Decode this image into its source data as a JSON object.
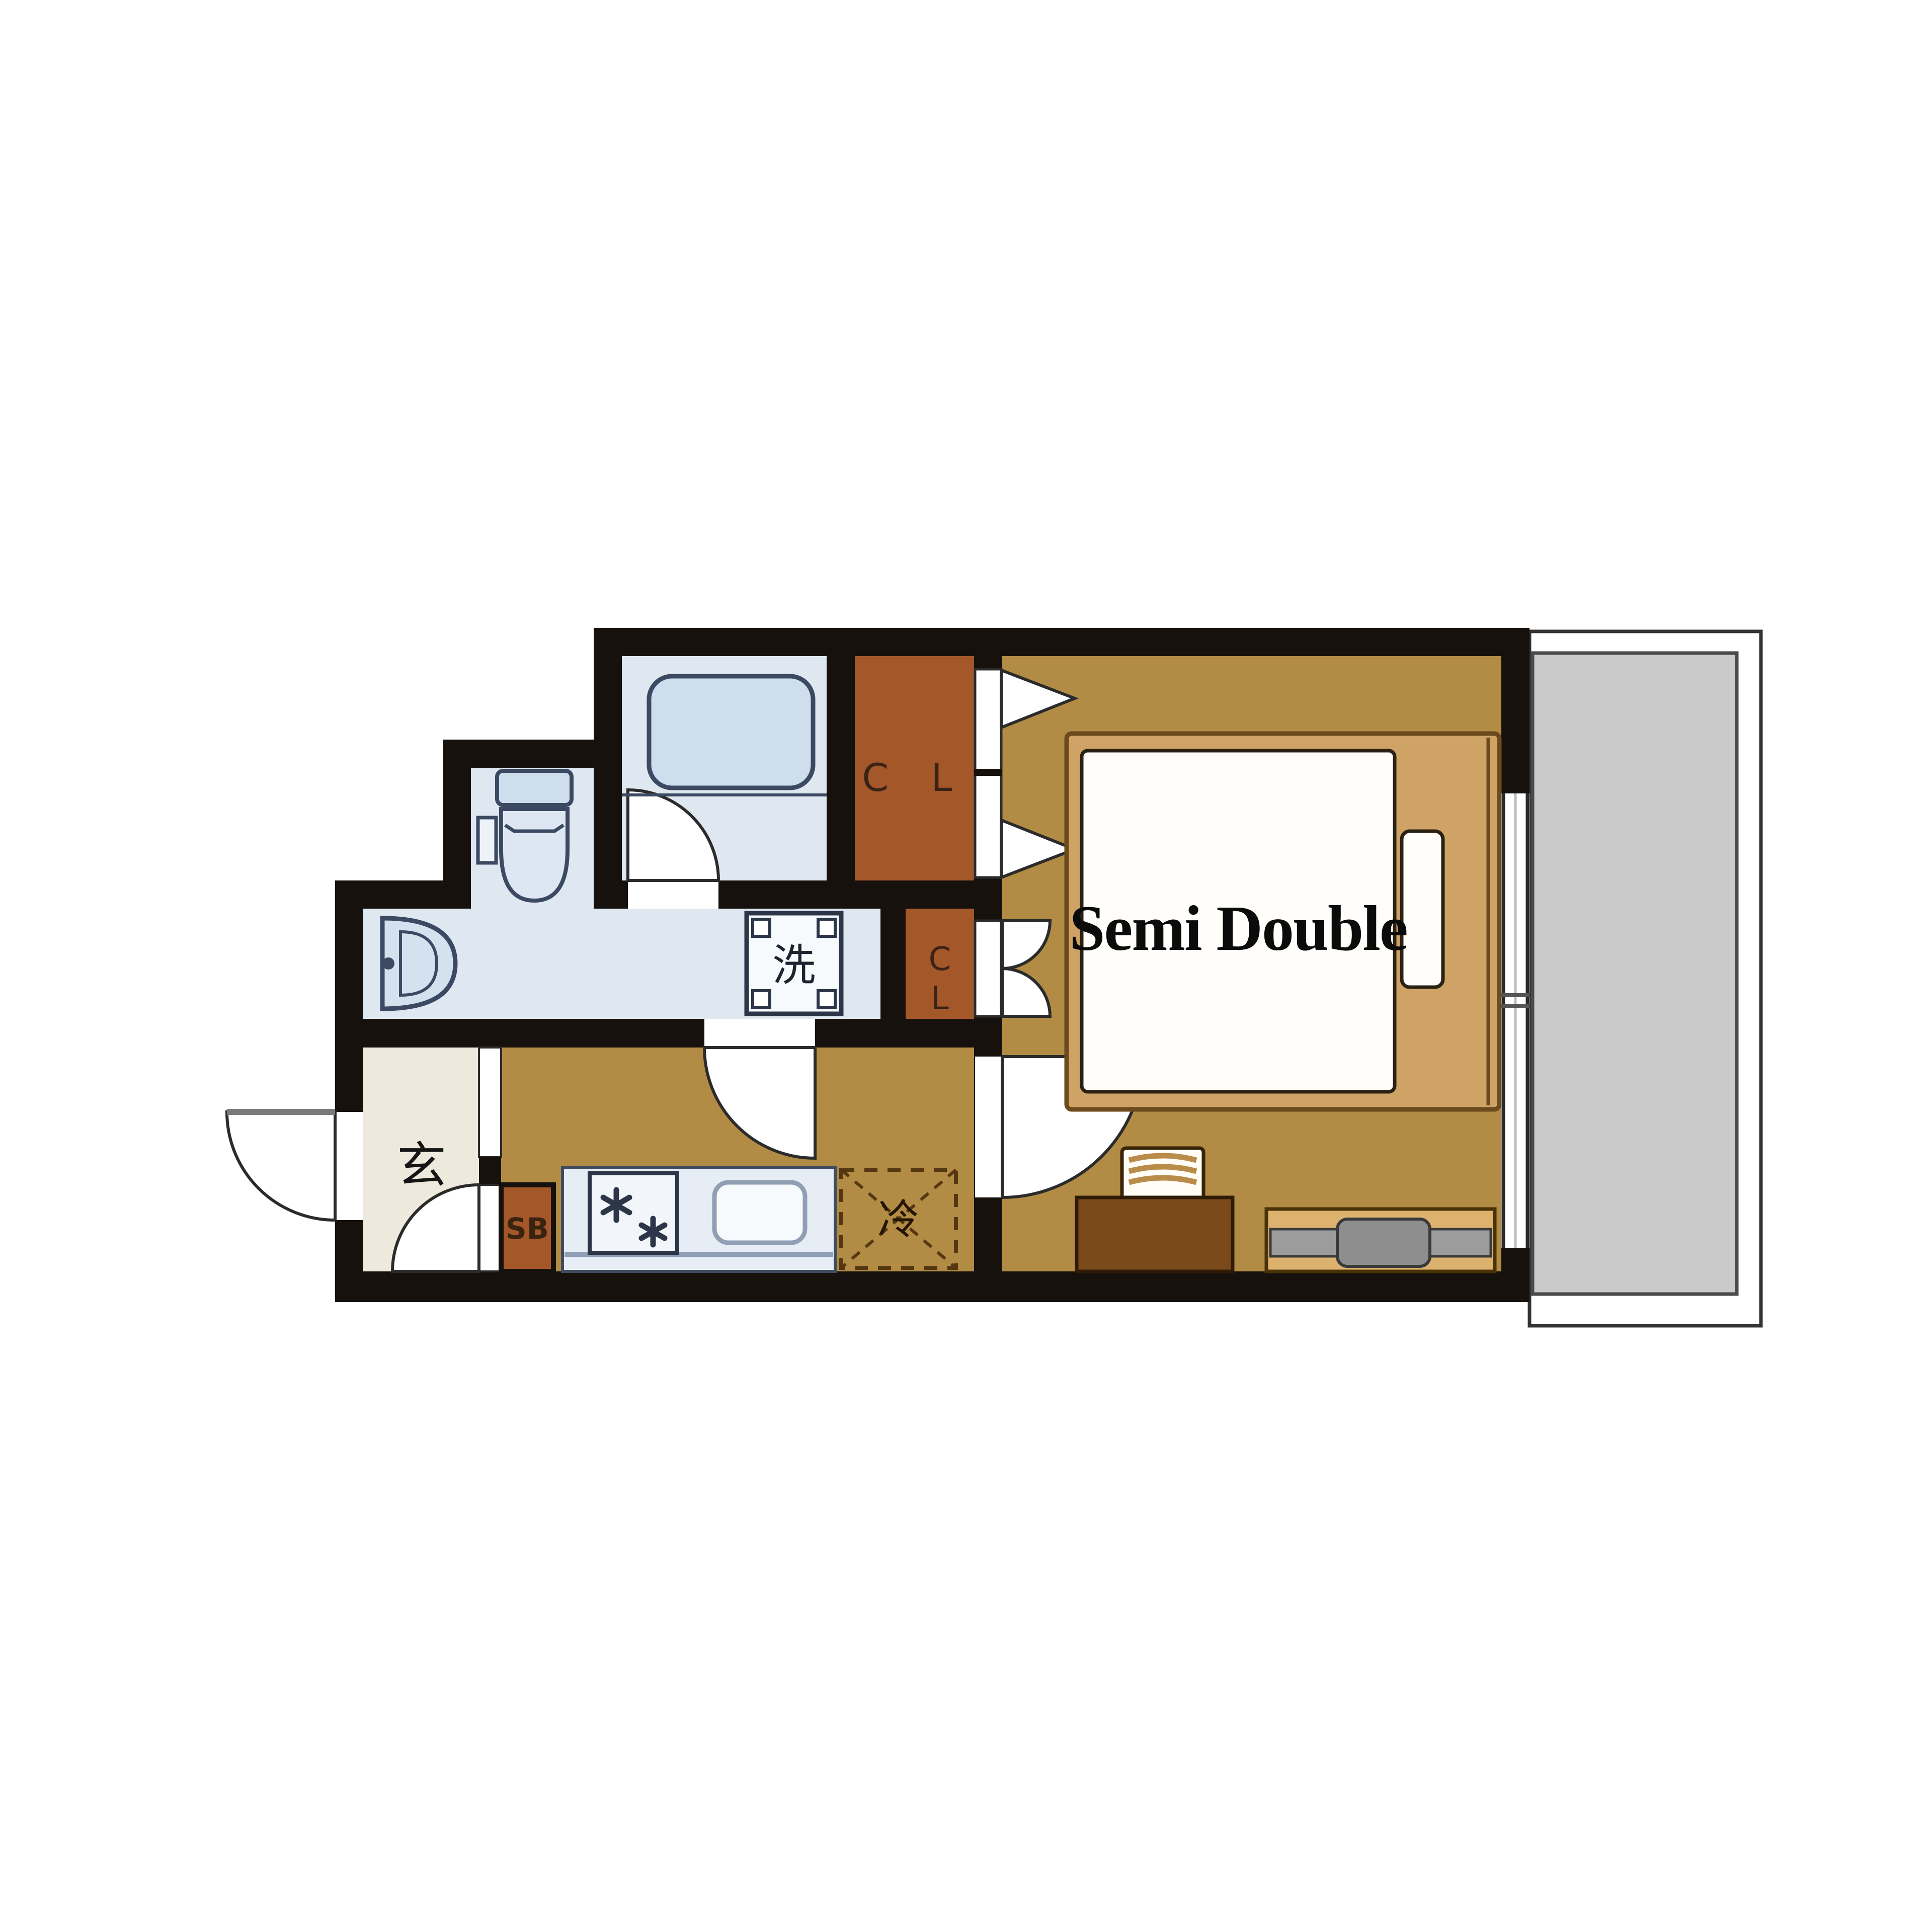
{
  "title": "1K apartment floor plan with semi double bed and balcony",
  "labels": {
    "closet_large": "C L",
    "closet_small_top": "C",
    "closet_small_bottom": "L",
    "washing_machine": "洗",
    "entrance": "玄",
    "shoe_box": "SB",
    "refrigerator": "冷",
    "bed": "Semi Double"
  },
  "rooms": [
    {
      "name": "bathroom",
      "feature": "bathtub"
    },
    {
      "name": "toilet-washroom",
      "feature": "toilet, sink, washing machine pan"
    },
    {
      "name": "entrance-genkan",
      "feature": "玄"
    },
    {
      "name": "hallway-kitchen",
      "feature": "2-burner stove, sink, refrigerator space"
    },
    {
      "name": "closet-large",
      "feature": "CL"
    },
    {
      "name": "closet-small",
      "feature": "CL"
    },
    {
      "name": "shoe-box",
      "feature": "SB"
    },
    {
      "name": "bedroom",
      "feature": "semi double bed, desk, chair, TV board"
    },
    {
      "name": "balcony",
      "feature": "gray deck"
    }
  ],
  "colors": {
    "wall": "#16110d",
    "wet_area_floor": "#dfe8f1",
    "fixture_fill": "#cfdeed",
    "fixture_stroke": "#3c4962",
    "closet": "#a4582a",
    "wood_floor": "#b28b45",
    "entrance_floor": "#edeadd",
    "kitchen_counter": "#e6edf5",
    "balcony_deck": "#cacaca",
    "bed_frame": "#cfa266",
    "mattress": "#fffefa",
    "desk": "#7b4a1b",
    "tv_board": "#ddb26f",
    "tv_gray": "#9c9c9c",
    "door_stroke": "#2b2b2b"
  }
}
